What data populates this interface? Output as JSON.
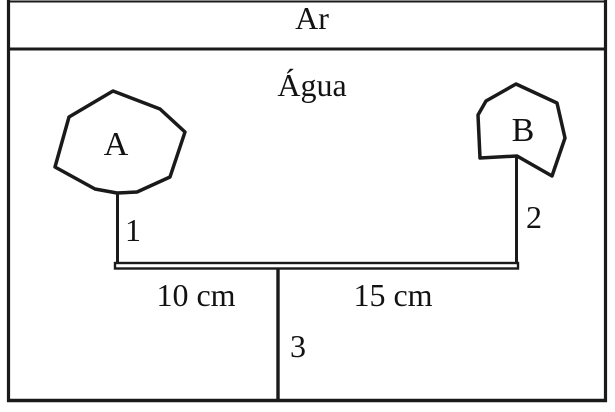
{
  "colors": {
    "line": "#1a1a1a",
    "background": "#ffffff",
    "text": "#121212"
  },
  "diagram": {
    "air_label": "Ar",
    "water_label": "Água",
    "body_a_label": "A",
    "body_b_label": "B",
    "string_1_label": "1",
    "string_2_label": "2",
    "support_3_label": "3",
    "distance_left_label": "10 cm",
    "distance_right_label": "15 cm"
  }
}
